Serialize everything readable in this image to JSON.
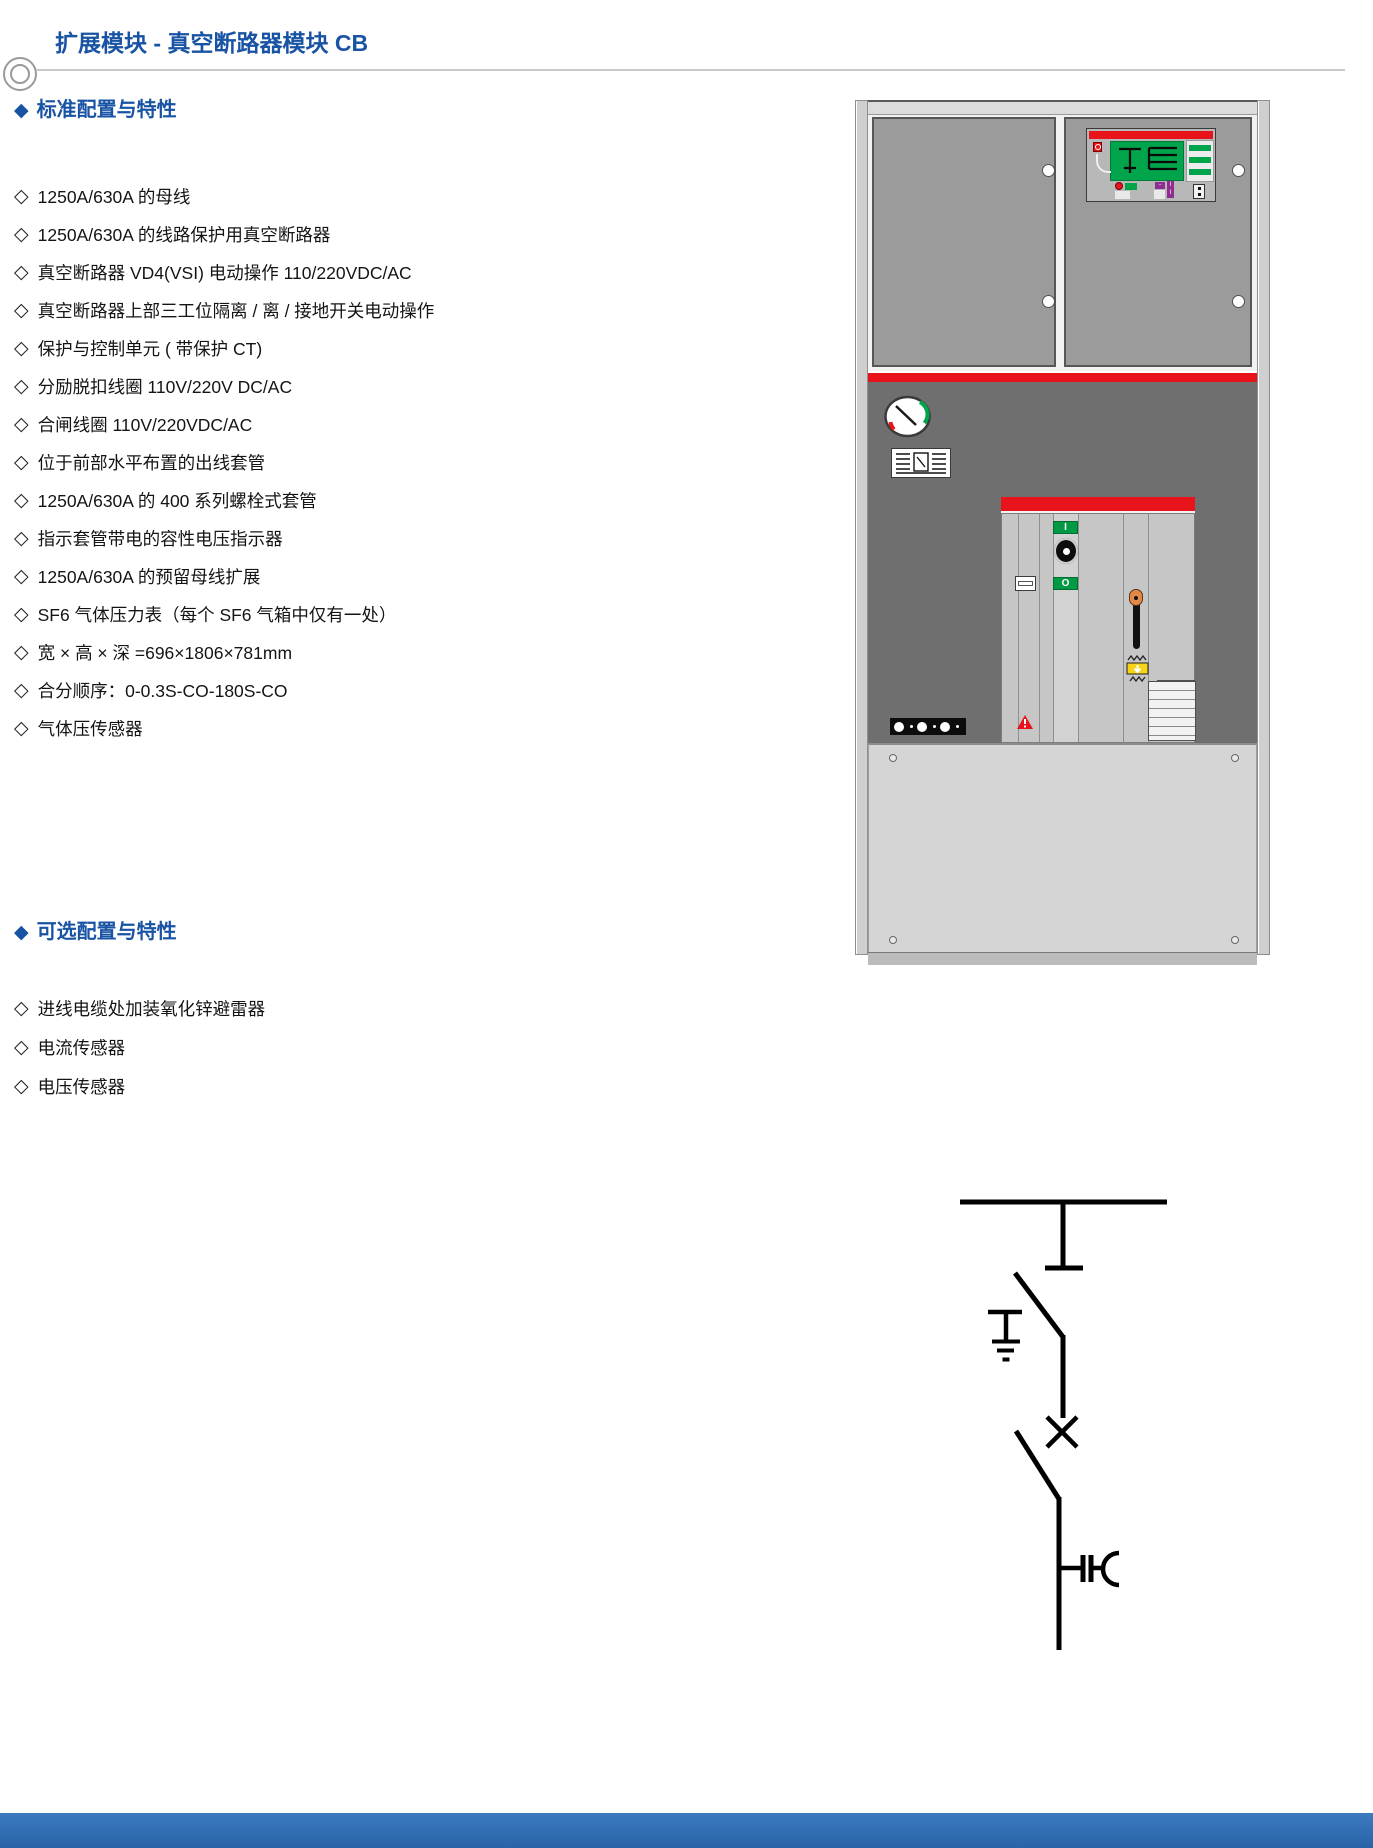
{
  "page": {
    "title": "扩展模块 - 真空断路器模块 CB"
  },
  "bullets": {
    "header_char": "◆",
    "item_char": "◇"
  },
  "sections": {
    "standard": {
      "heading": "标准配置与特性",
      "items": [
        "1250A/630A 的母线",
        "1250A/630A 的线路保护用真空断路器",
        "真空断路器 VD4(VSI) 电动操作 110/220VDC/AC",
        "真空断路器上部三工位隔离 / 离 / 接地开关电动操作",
        "保护与控制单元 ( 带保护 CT)",
        "分励脱扣线圈 110V/220V DC/AC",
        "合闸线圈 110V/220VDC/AC",
        "位于前部水平布置的出线套管",
        "1250A/630A 的 400 系列螺栓式套管",
        "指示套管带电的容性电压指示器",
        "1250A/630A 的预留母线扩展",
        "SF6 气体压力表（每个 SF6 气箱中仅有一处）",
        "宽 × 高 × 深 =696×1806×781mm",
        "合分顺序：0-0.3S-CO-180S-CO",
        "气体压传感器"
      ]
    },
    "optional": {
      "heading": "可选配置与特性",
      "items": [
        "进线电缆处加装氧化锌避雷器",
        "电流传感器",
        "电压传感器"
      ]
    }
  },
  "equipment": {
    "breaker_close_label": "I",
    "breaker_open_label": "O"
  },
  "colors": {
    "accent_blue": "#1953a4",
    "cabinet_red": "#e8131b",
    "button_green": "#009a44",
    "display_green": "#00a44a",
    "warning_yellow": "#f7d417",
    "footer_blue": "#3473b9"
  }
}
